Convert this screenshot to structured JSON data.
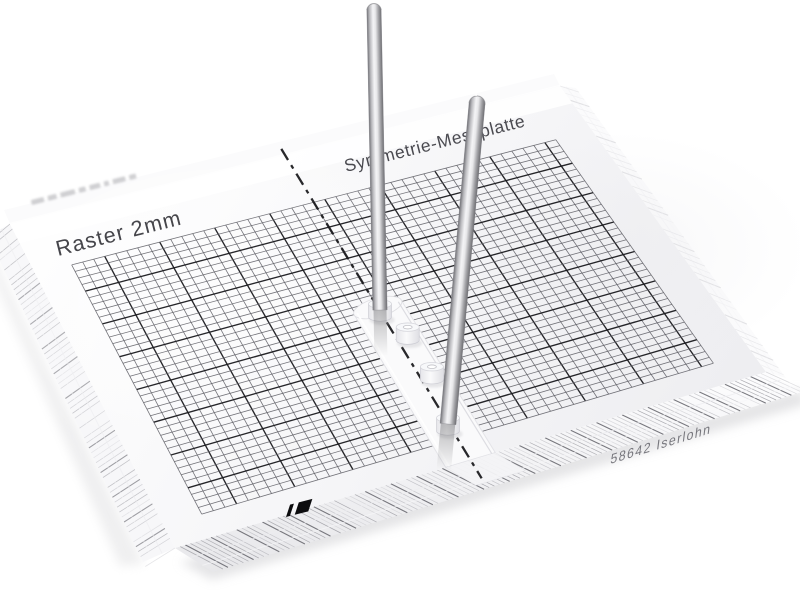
{
  "scene": {
    "type": "product-photo",
    "background": "#ffffff",
    "object": "transparent-acrylic-symmetry-measuring-plate-with-two-steel-pins"
  },
  "plate": {
    "labels": {
      "raster": "Raster 2mm",
      "title": "Symmetrie-Messplatte",
      "edge_imprint": "58642 Iserlohn"
    },
    "grid": {
      "cell": "2mm",
      "cols": 44,
      "rows": 38,
      "major_every": 5
    },
    "pins": {
      "count": 2
    },
    "sockets": {
      "count": 4
    },
    "colors": {
      "grid_minor": "#5d5d64",
      "grid_major": "#1b1b1f",
      "axis": "#17171a",
      "label_text": "#45454a",
      "edge_text": "#63636a",
      "logo": "#0c0c0e",
      "pin_dark": "#717176",
      "pin_light": "#f4f4f6",
      "acrylic_tint": "#f3f3f5",
      "shadow": "#cfcfd2"
    }
  }
}
